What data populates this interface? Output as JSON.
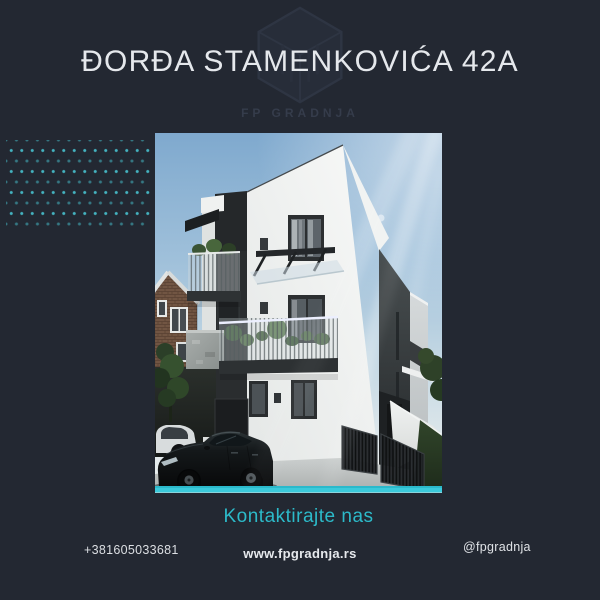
{
  "page": {
    "background_color": "#232832",
    "accent_color": "#2ebed0"
  },
  "header": {
    "title": "ĐORĐA STAMENKOVIĆA 42A",
    "watermark_text": "FP GRADNJA"
  },
  "photo": {
    "description": "3D render of a modern three-story white residential building with dark window frames, steel balconies with plants, a glass canopy, a black sedan parked in front, a neighboring brick house and greenery"
  },
  "contact": {
    "heading": "Kontaktirajte nas",
    "phone": "+381605033681",
    "website": "www.fpgradnja.rs",
    "instagram_handle": "@fpgradnja"
  }
}
